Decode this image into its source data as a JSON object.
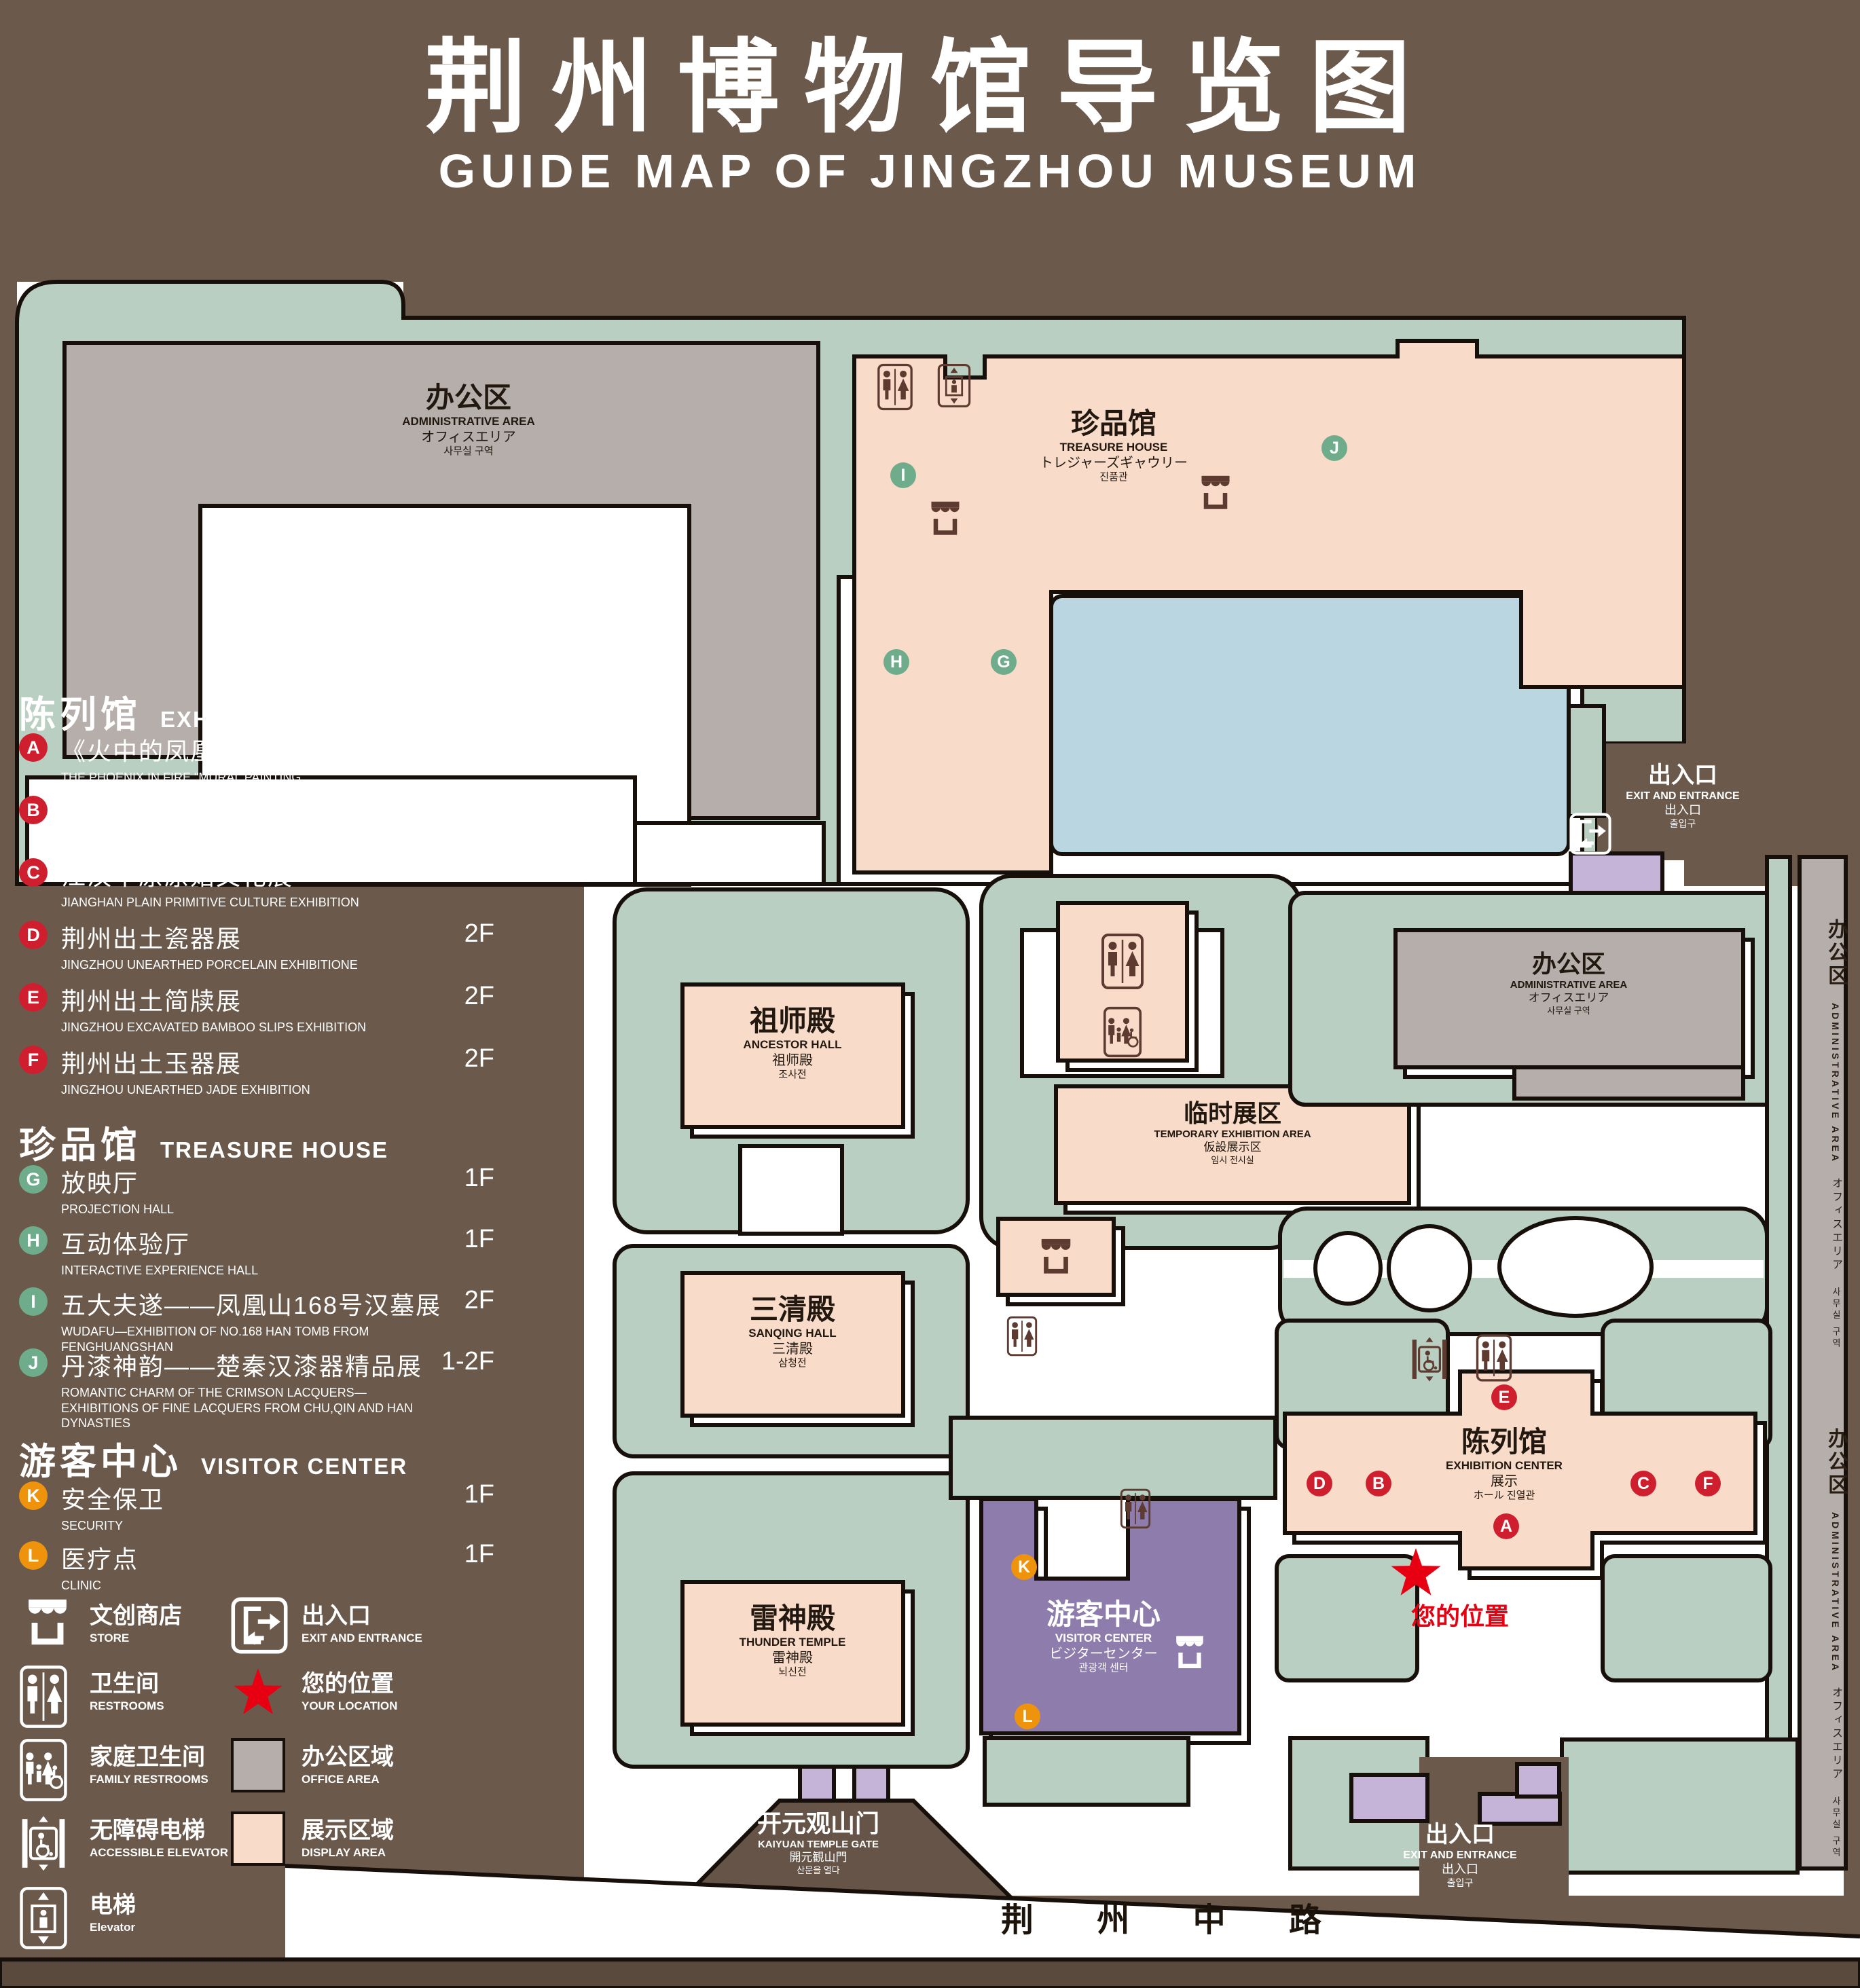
{
  "title": {
    "zh": "荆州博物馆导览图",
    "en": "GUIDE MAP OF JINGZHOU MUSEUM"
  },
  "legend": {
    "sections": [
      {
        "zh": "陈列馆",
        "en": "EXHIBITION CENTER",
        "items": [
          {
            "key": "A",
            "zh": "《火中的凤凰》壁画",
            "en": "THE PHOENIX IN FIRE \"MURAL PAINTING",
            "floor": "1F"
          },
          {
            "key": "B",
            "zh": "荆州出土铜器展",
            "en": "JINGZHOU UNEARTHED BRONZE WARE EXHIBITION",
            "floor": "1F"
          },
          {
            "key": "C",
            "zh": "江汉平原原始文化展",
            "en": "JIANGHAN PLAIN PRIMITIVE CULTURE EXHIBITION",
            "floor": "1F"
          },
          {
            "key": "D",
            "zh": "荆州出土瓷器展",
            "en": "JINGZHOU UNEARTHED PORCELAIN EXHIBITIONE",
            "floor": "2F"
          },
          {
            "key": "E",
            "zh": "荆州出土简牍展",
            "en": "JINGZHOU EXCAVATED BAMBOO SLIPS EXHIBITION",
            "floor": "2F"
          },
          {
            "key": "F",
            "zh": "荆州出土玉器展",
            "en": "JINGZHOU UNEARTHED JADE EXHIBITION",
            "floor": "2F"
          }
        ]
      },
      {
        "zh": "珍品馆",
        "en": "TREASURE HOUSE",
        "items": [
          {
            "key": "G",
            "zh": "放映厅",
            "en": "PROJECTION HALL",
            "floor": "1F"
          },
          {
            "key": "H",
            "zh": "互动体验厅",
            "en": "INTERACTIVE EXPERIENCE HALL",
            "floor": "1F"
          },
          {
            "key": "I",
            "zh": "五大夫遂——凤凰山168号汉墓展",
            "en": "WUDAFU—EXHIBITION OF NO.168 HAN TOMB FROM FENGHUANGSHAN",
            "floor": "2F"
          },
          {
            "key": "J",
            "zh": "丹漆神韵——楚秦汉漆器精品展",
            "en": "ROMANTIC CHARM OF THE CRIMSON LACQUERS—EXHIBITIONS OF FINE LACQUERS FROM CHU,QIN AND HAN DYNASTIES",
            "floor": "1-2F"
          }
        ]
      },
      {
        "zh": "游客中心",
        "en": "VISITOR CENTER",
        "items": [
          {
            "key": "K",
            "zh": "安全保卫",
            "en": "SECURITY",
            "floor": "1F"
          },
          {
            "key": "L",
            "zh": "医疗点",
            "en": "CLINIC",
            "floor": "1F"
          }
        ]
      }
    ],
    "symbols": [
      {
        "icon": "store-icon",
        "zh": "文创商店",
        "en": "STORE"
      },
      {
        "icon": "restroom-icon",
        "zh": "卫生间",
        "en": "RESTROOMS"
      },
      {
        "icon": "family-restroom-icon",
        "zh": "家庭卫生间",
        "en": "FAMILY RESTROOMS"
      },
      {
        "icon": "accessible-elevator-icon",
        "zh": "无障碍电梯",
        "en": "ACCESSIBLE ELEVATOR"
      },
      {
        "icon": "elevator-icon",
        "zh": "电梯",
        "en": "Elevator"
      },
      {
        "icon": "exit-icon",
        "zh": "出入口",
        "en": "EXIT AND ENTRANCE"
      },
      {
        "icon": "your-location-star-icon",
        "zh": "您的位置",
        "en": "YOUR LOCATION"
      },
      {
        "icon": "office-area-swatch",
        "zh": "办公区域",
        "en": "OFFICE AREA"
      },
      {
        "icon": "display-area-swatch",
        "zh": "展示区域",
        "en": "DISPLAY AREA"
      }
    ]
  },
  "map": {
    "labels": {
      "admin_top": {
        "zh": "办公区",
        "en": "ADMINISTRATIVE AREA",
        "ja": "オフィスエリア",
        "ko": "사무실 구역"
      },
      "admin_right": {
        "zh": "办公区",
        "en": "ADMINISTRATIVE AREA",
        "ja": "オフィスエリア",
        "ko": "사무실 구역"
      },
      "admin_strip": {
        "zh": "办公区",
        "en": "ADMINISTRATIVE AREA",
        "ja": "オフィスエリア",
        "ko": "사무실 구역"
      },
      "treasure": {
        "zh": "珍品馆",
        "en": "TREASURE HOUSE",
        "ja": "トレジャーズギャウリー",
        "ko": "진품관"
      },
      "ancestor": {
        "zh": "祖师殿",
        "en": "ANCESTOR HALL",
        "ja": "祖师殿",
        "ko": "조사전"
      },
      "sanqing": {
        "zh": "三清殿",
        "en": "SANQING HALL",
        "ja": "三清殿",
        "ko": "삼청전"
      },
      "thunder": {
        "zh": "雷神殿",
        "en": "THUNDER TEMPLE",
        "ja": "雷神殿",
        "ko": "뇌신전"
      },
      "temporary": {
        "zh": "临时展区",
        "en": "TEMPORARY EXHIBITION AREA",
        "ja": "仮設展示区",
        "ko": "임시 전시실"
      },
      "visitor": {
        "zh": "游客中心",
        "en": "VISITOR CENTER",
        "ja": "ビジターセンター",
        "ko": "관광객 센터"
      },
      "exhibition": {
        "zh": "陈列馆",
        "en": "EXHIBITION CENTER",
        "ja": "展示",
        "ko": "ホール 진열관"
      },
      "gate": {
        "zh": "开元观山门",
        "en": "KAIYUAN TEMPLE GATE",
        "ja": "開元観山門",
        "ko": "산문을 열다"
      },
      "exit_top": {
        "zh": "出入口",
        "en": "EXIT AND ENTRANCE",
        "ja": "出入口",
        "ko": "출입구"
      },
      "exit_bottom": {
        "zh": "出入口",
        "en": "EXIT AND ENTRANCE",
        "ja": "出入口",
        "ko": "출입구"
      },
      "your_location": {
        "zh": "您的位置"
      },
      "road": {
        "zh": "荆 州 中 路"
      }
    },
    "markers": {
      "a": "A",
      "b": "B",
      "c": "C",
      "d": "D",
      "e": "E",
      "f": "F",
      "g": "G",
      "h": "H",
      "i": "I",
      "j": "J",
      "k": "K",
      "l": "L"
    }
  },
  "colors": {
    "background": "#6b5a4c",
    "campus_green": "#b9cfc1",
    "display_pink": "#f8dcc9",
    "office_gray": "#b6aeaa",
    "pond_blue": "#b9d6e1",
    "visitor_purple": "#8e7dac",
    "gate_lavender": "#c6b4d8",
    "icon_brown": "#5d3b31",
    "marker_red": "#cf1f2f",
    "marker_green": "#6fac8c",
    "marker_orange": "#f0930c",
    "star_red": "#e60012",
    "road_strip_brown": "#5a4a3d"
  }
}
